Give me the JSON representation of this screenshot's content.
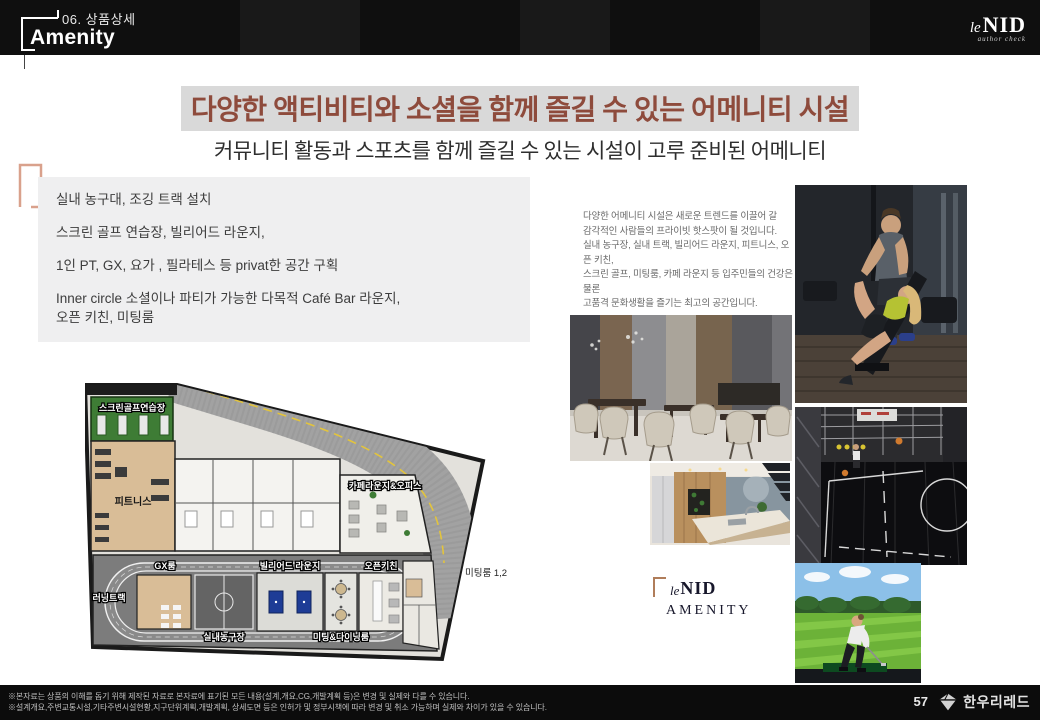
{
  "colors": {
    "accent_brown": "#8e4b3c",
    "highlight_gray": "#d9d9d9",
    "box_gray": "#efeff0",
    "bracket_salmon": "#d9a18c",
    "header_black": "#0f0f0f"
  },
  "header": {
    "section": "06. 상품상세",
    "page_title": "Amenity",
    "brand_le": "le",
    "brand_nid": "NID",
    "brand_tagline": "author check"
  },
  "hero": {
    "headline": "다양한 액티비티와 소셜을 함께 즐길 수 있는 어메니티 시설",
    "subheadline": "커뮤니티 활동과 스포츠를 함께 즐길 수 있는 시설이 고루 준비된 어메니티"
  },
  "features": {
    "items": [
      "실내 농구대, 조깅 트랙 설치",
      "스크린 골프 연습장, 빌리어드 라운지,",
      "1인 PT, GX, 요가 , 필라테스 등 privat한 공간 구획",
      "Inner circle 소셜이나 파티가 가능한 다목적 Café Bar 라운지,\n오픈 키친, 미팅룸"
    ]
  },
  "description": {
    "lines": [
      "다양한 어메니티 시설은 새로운 트렌드를 이끌어 갈",
      "감각적인 사람들의 프라이빗 핫스팟이 될 것입니다.",
      "실내 농구장, 실내 트랙, 빌리어드 라운지, 피트니스, 오픈 키친,",
      "스크린 골프, 미팅룸, 카페 라운지 등 입주민들의 건강은 물론",
      "고품격 문화생활을 즐기는 최고의 공간입니다."
    ]
  },
  "floor_plan": {
    "labels": {
      "screen_golf": "스크린골프연습장",
      "fitness": "피트니스",
      "gx_room": "GX룸",
      "running_track": "러닝트랙",
      "basketball": "실내농구장",
      "billiard": "빌리어드 라운지",
      "meeting_dining": "미팅&다이닝룸",
      "open_kitchen": "오픈키친",
      "cafe_lounge": "카페라운지&오피스",
      "meeting_rooms": "미팅룸 1,2"
    }
  },
  "brand_mark": {
    "le": "le",
    "nid": "NID",
    "label": "AMENITY"
  },
  "footer": {
    "disclaimer_line1": "※본자료는 상품의 이해를 돕기 위해 제작된 자료로 본자료에 표기된 모든 내용(설계,개요,CG,개발계획 등)은 변경 및 실제와 다를 수 있습니다.",
    "disclaimer_line2": "※설계개요,주변교통시설,기타주변시설현황,지구단위계획,개발계획, 상세도면 등은 인허가 및 정부시책에 따라 변경 및 취소 가능하며 실제와 차이가 있을 수 있습니다.",
    "page_number": "57",
    "company": "한우리레드"
  }
}
